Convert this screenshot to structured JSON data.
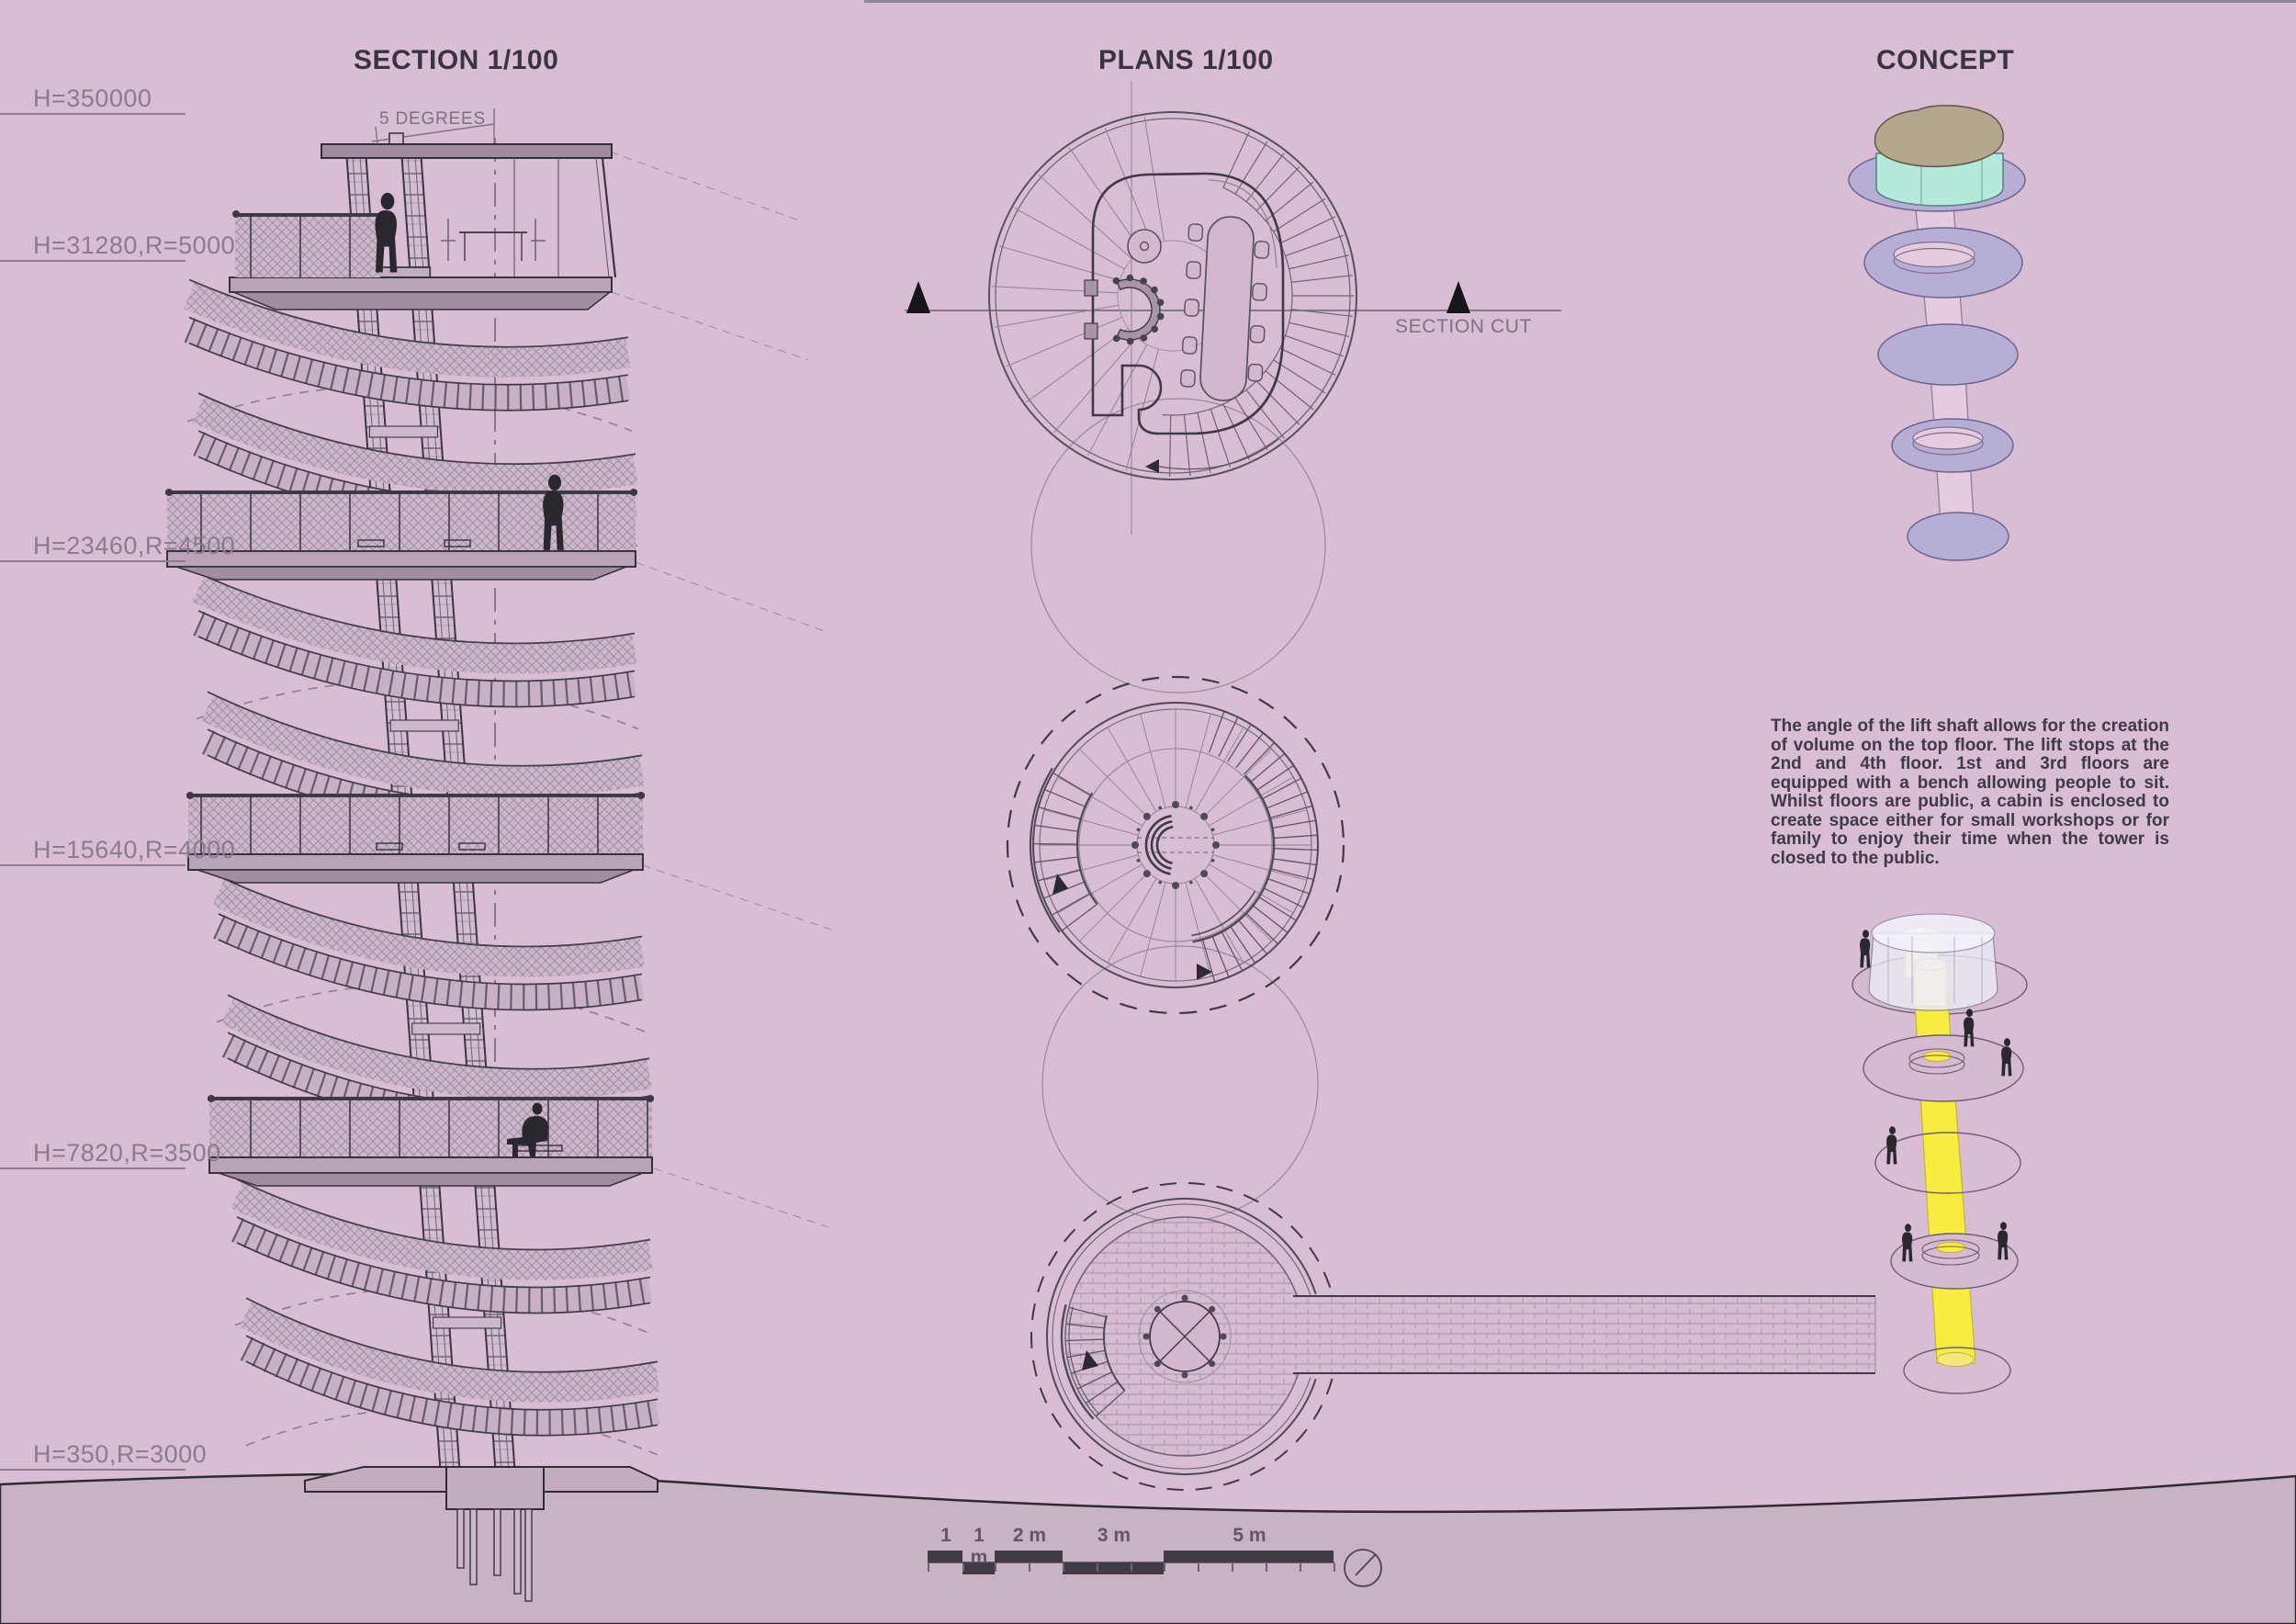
{
  "titles": {
    "section": "SECTION 1/100",
    "plans": "PLANS 1/100",
    "concept": "CONCEPT"
  },
  "section": {
    "angle_label": "5 DEGREES",
    "height_labels": [
      "H=350000",
      "H=31280,R=5000",
      "H=23460,R=4500",
      "H=15640,R=4000",
      "H=7820,R=3500",
      "H=350,R=3000"
    ]
  },
  "plans": {
    "section_cut_label": "SECTION CUT"
  },
  "concept": {
    "paragraph": "The angle of the lift shaft allows for the creation of volume on the top floor. The lift stops at the 2nd and 4th floor. 1st and 3rd floors are equipped with a bench allowing people to sit. Whilst floors are public, a cabin is enclosed to create space either for small workshops or for family to enjoy their time when the tower is closed to the public."
  },
  "scale_bar": {
    "labels": [
      "1 m",
      "1 m",
      "2 m",
      "3 m",
      "5 m"
    ]
  },
  "colors": {
    "background": "#d9bdd5",
    "ground": "#c8b2c3",
    "ink_dark": "#3a3440",
    "ink_mid": "#6b6273",
    "ink_light": "#9b8fa0",
    "slab": "#b9a3b6",
    "mesh_fill": "#cdb6c9",
    "axon_disc": "#b6aed4",
    "axon_shaft_pink": "#e6cade",
    "cabin_teal": "#b4e9db",
    "roof_tan": "#b4a78d",
    "lift_yellow": "#f9ec40",
    "pale_yellow": "#fdf5c2",
    "glass": "#eceaf5",
    "person": "#2b272f"
  }
}
